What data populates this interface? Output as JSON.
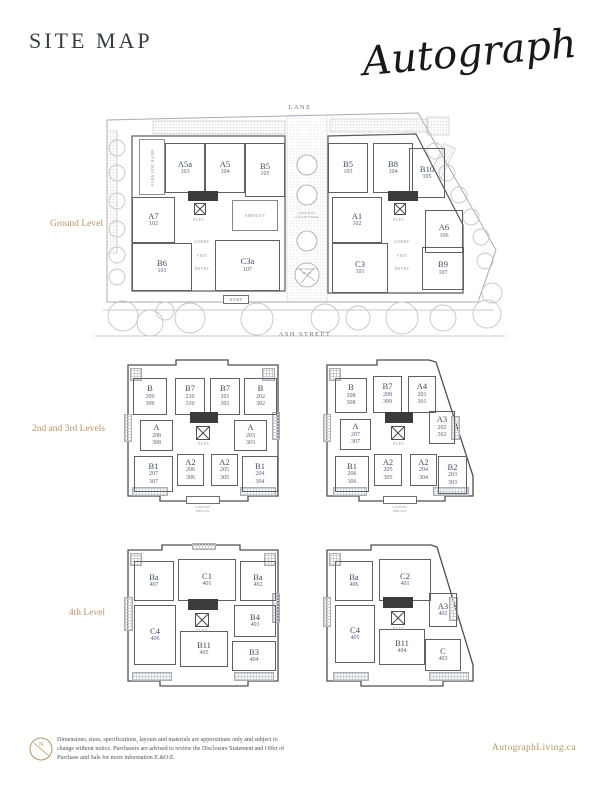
{
  "header": {
    "title": "SITE MAP",
    "brand": "Autograph"
  },
  "common": {
    "elev": "ELEV",
    "canopy": "CANOPY\nBELOW"
  },
  "ground": {
    "label": "Ground Level",
    "lane": "LANE",
    "street": "ASH STREET",
    "courtyard": "CENTRAL\nCOURTYARD",
    "childrens_play": "CHILDREN'S\nPLAY",
    "west": {
      "units": [
        {
          "t": "A5a",
          "n": "103"
        },
        {
          "t": "A5",
          "n": "104"
        },
        {
          "t": "B5",
          "n": "105"
        },
        {
          "t": "A7",
          "n": "102"
        },
        {
          "t": "B6",
          "n": "101"
        },
        {
          "t": "C3a",
          "n": "107"
        }
      ],
      "amenity": "AMENITY",
      "parkade": "PARKADE RAMP",
      "lobby": "LOBBY",
      "vest": "VEST",
      "entry": "ENTRY",
      "ramp": "RAMP"
    },
    "east": {
      "units": [
        {
          "t": "B5",
          "n": "103"
        },
        {
          "t": "B8",
          "n": "104"
        },
        {
          "t": "B10",
          "n": "105"
        },
        {
          "t": "A1",
          "n": "102"
        },
        {
          "t": "A6",
          "n": "106"
        },
        {
          "t": "C3",
          "n": "101"
        },
        {
          "t": "B9",
          "n": "107"
        }
      ],
      "lobby": "LOBBY",
      "vest": "VEST",
      "entry": "ENTRY"
    }
  },
  "levels23": {
    "label": "2nd and 3rd Levels",
    "west": {
      "units": [
        {
          "t": "B",
          "n": "209\n309"
        },
        {
          "t": "B7",
          "n": "210\n310"
        },
        {
          "t": "B7",
          "n": "201\n301"
        },
        {
          "t": "B",
          "n": "202\n302"
        },
        {
          "t": "A",
          "n": "208\n308"
        },
        {
          "t": "A",
          "n": "203\n303"
        },
        {
          "t": "B1",
          "n": "207\n307"
        },
        {
          "t": "A2",
          "n": "206\n306"
        },
        {
          "t": "A2",
          "n": "205\n305"
        },
        {
          "t": "B1",
          "n": "204\n304"
        }
      ]
    },
    "east": {
      "units": [
        {
          "t": "B",
          "n": "208\n308"
        },
        {
          "t": "B7",
          "n": "209\n309"
        },
        {
          "t": "A4",
          "n": "201\n301"
        },
        {
          "t": "A",
          "n": "207\n307"
        },
        {
          "t": "A3",
          "n": "202\n302"
        },
        {
          "t": "B1",
          "n": "206\n306"
        },
        {
          "t": "A2",
          "n": "205\n305"
        },
        {
          "t": "A2",
          "n": "204\n304"
        },
        {
          "t": "B2",
          "n": "203\n303"
        }
      ]
    }
  },
  "level4": {
    "label": "4th Level",
    "west": {
      "units": [
        {
          "t": "Ba",
          "n": "407"
        },
        {
          "t": "C1",
          "n": "401"
        },
        {
          "t": "Ba",
          "n": "402"
        },
        {
          "t": "B4",
          "n": "403"
        },
        {
          "t": "C4",
          "n": "406"
        },
        {
          "t": "B11",
          "n": "405"
        },
        {
          "t": "B3",
          "n": "404"
        }
      ]
    },
    "east": {
      "units": [
        {
          "t": "Ba",
          "n": "406"
        },
        {
          "t": "C2",
          "n": "401"
        },
        {
          "t": "A3",
          "n": "402"
        },
        {
          "t": "C4",
          "n": "405"
        },
        {
          "t": "B11",
          "n": "404"
        },
        {
          "t": "C",
          "n": "403"
        }
      ]
    }
  },
  "footer": {
    "disclaimer": "Dimensions, sizes, specifications, layouts and materials are approximate only and subject to change without notice. Purchasers are advised to review the Disclosure Statement and Offer of Purchase and Sale for more information E.&O.E.",
    "website": "AutographLiving.ca"
  },
  "colors": {
    "accent": "#b5946a",
    "unit_label": "#3e4a5e",
    "line_dark": "#55595e",
    "line_light": "#a7abb0"
  }
}
